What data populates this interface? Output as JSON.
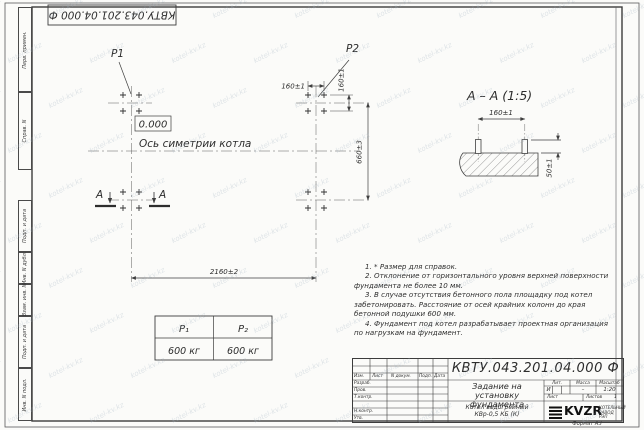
{
  "watermark": {
    "text": "kotel-kv.kz"
  },
  "frame": {
    "top_stamp": "КВТУ.043.201.04.000  Ф",
    "margin_labels": [
      "Перв. примен.",
      "Справ. N",
      "Подп. и дата",
      "Инв. N дубл.",
      "Взам. инв. N",
      "Подп. и дата",
      "Инв. N подл."
    ],
    "format_label": "Формат А3"
  },
  "plan": {
    "load1_label": "P1",
    "load2_label": "P2",
    "elevation": "0.000",
    "axis_label": "Ось симетрии котла",
    "dim_width": "2160±2",
    "dim_height": "660±3",
    "dim_bolt_h": "160±1",
    "dim_bolt_v": "160±1",
    "section_letter_left": "А",
    "section_letter_right": "А"
  },
  "section_view": {
    "title": "А – А (1:5)",
    "dim_bolt_spacing": "160±1",
    "dim_bolt_height": "50±1"
  },
  "load_table": {
    "headers": [
      "P₁",
      "P₂"
    ],
    "values": [
      "600 кг",
      "600 кг"
    ]
  },
  "notes": [
    "1. * Размер для справок.",
    "2. Отклонение от горизонтального уровня верхней поверхности фундамента не более 10 мм.",
    "3. В случае отсутствия бетонного пола площадку под котел забетонировать. Расстояние от осей крайних колонн до края бетонной подушки 600 мм.",
    "4. Фундамент под котел разрабатывает проектная организация по нагрузкам на фундамент."
  ],
  "title_block": {
    "doc_number": "КВТУ.043.201.04.000 Ф",
    "title": "Задание на установку фундамента",
    "product": "Котел водогрейный КВр-0,5 КБ (К)",
    "header_cols": [
      "Изм.",
      "Лист",
      "N докум.",
      "Подп.",
      "Дата"
    ],
    "sig_rows": [
      "Разраб.",
      "Пров.",
      "Т.контр.",
      "Н.контр.",
      "Утв."
    ],
    "lit_label": "Лит.",
    "mass_label": "Масса",
    "scale_label": "Масштаб",
    "lit_value": "И",
    "mass_value": "–",
    "scale_value": "1:20",
    "sheet_label": "Лист",
    "sheets_label": "Листов",
    "sheets_value": "1",
    "logo_text": "KVZR",
    "company": "КОТЕЛЬНЫЙ ЗАВОД РЭП"
  }
}
